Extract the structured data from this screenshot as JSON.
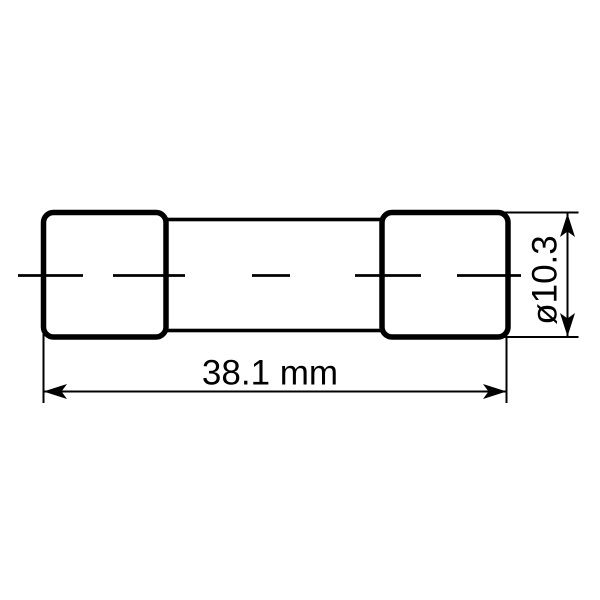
{
  "drawing": {
    "subject": "cartridge-fuse-dimension-drawing",
    "view": "side-view-technical-drawing",
    "length_dimension": {
      "label": "38.1 mm",
      "value": 38.1,
      "unit": "mm",
      "orientation": "horizontal"
    },
    "diameter_dimension": {
      "label": "ø10.3",
      "value": 10.3,
      "symbol": "ø",
      "orientation": "vertical"
    },
    "colors": {
      "line": "#000000",
      "background": "#ffffff"
    }
  }
}
